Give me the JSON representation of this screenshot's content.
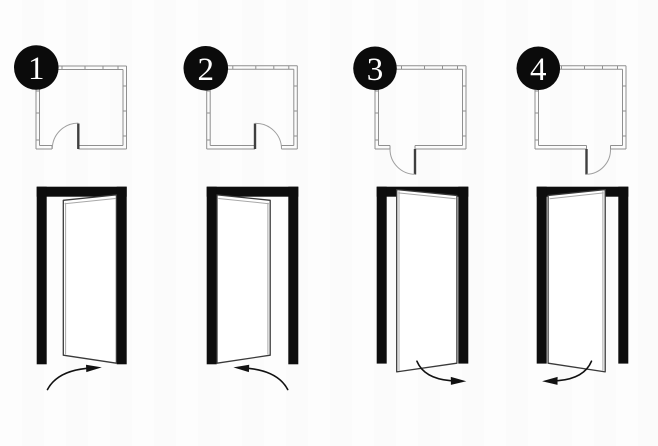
{
  "figure": {
    "description": "Four door swing options, each shown as a floor plan (top) and a door elevation with swing arrow (bottom)"
  },
  "colors": {
    "frame_black": "#0d0d0d",
    "wall_gray": "#8f8f8f",
    "plan_leaf": "#3f3f3f",
    "plan_arc": "#9e9e9e",
    "door_outline": "#3a3a3a",
    "edge_gray": "#a8a8a8",
    "arrow_black": "#111111",
    "badge_bg": "#0b0b0b",
    "badge_text": "#ffffff"
  },
  "variants": [
    {
      "number": "1",
      "plan": {
        "door_position": "bottom-left",
        "hinge": "right",
        "swing": "inward"
      },
      "elevation": {
        "hinge": "right",
        "opens": "toward-viewer",
        "arrow_direction": "right"
      }
    },
    {
      "number": "2",
      "plan": {
        "door_position": "bottom-right",
        "hinge": "left",
        "swing": "inward"
      },
      "elevation": {
        "hinge": "left",
        "opens": "toward-viewer",
        "arrow_direction": "left"
      }
    },
    {
      "number": "3",
      "plan": {
        "door_position": "bottom-left",
        "hinge": "right",
        "swing": "outward"
      },
      "elevation": {
        "hinge": "right",
        "opens": "away-from-viewer",
        "arrow_direction": "right"
      }
    },
    {
      "number": "4",
      "plan": {
        "door_position": "bottom-right",
        "hinge": "left",
        "swing": "outward"
      },
      "elevation": {
        "hinge": "left",
        "opens": "away-from-viewer",
        "arrow_direction": "left"
      }
    }
  ]
}
